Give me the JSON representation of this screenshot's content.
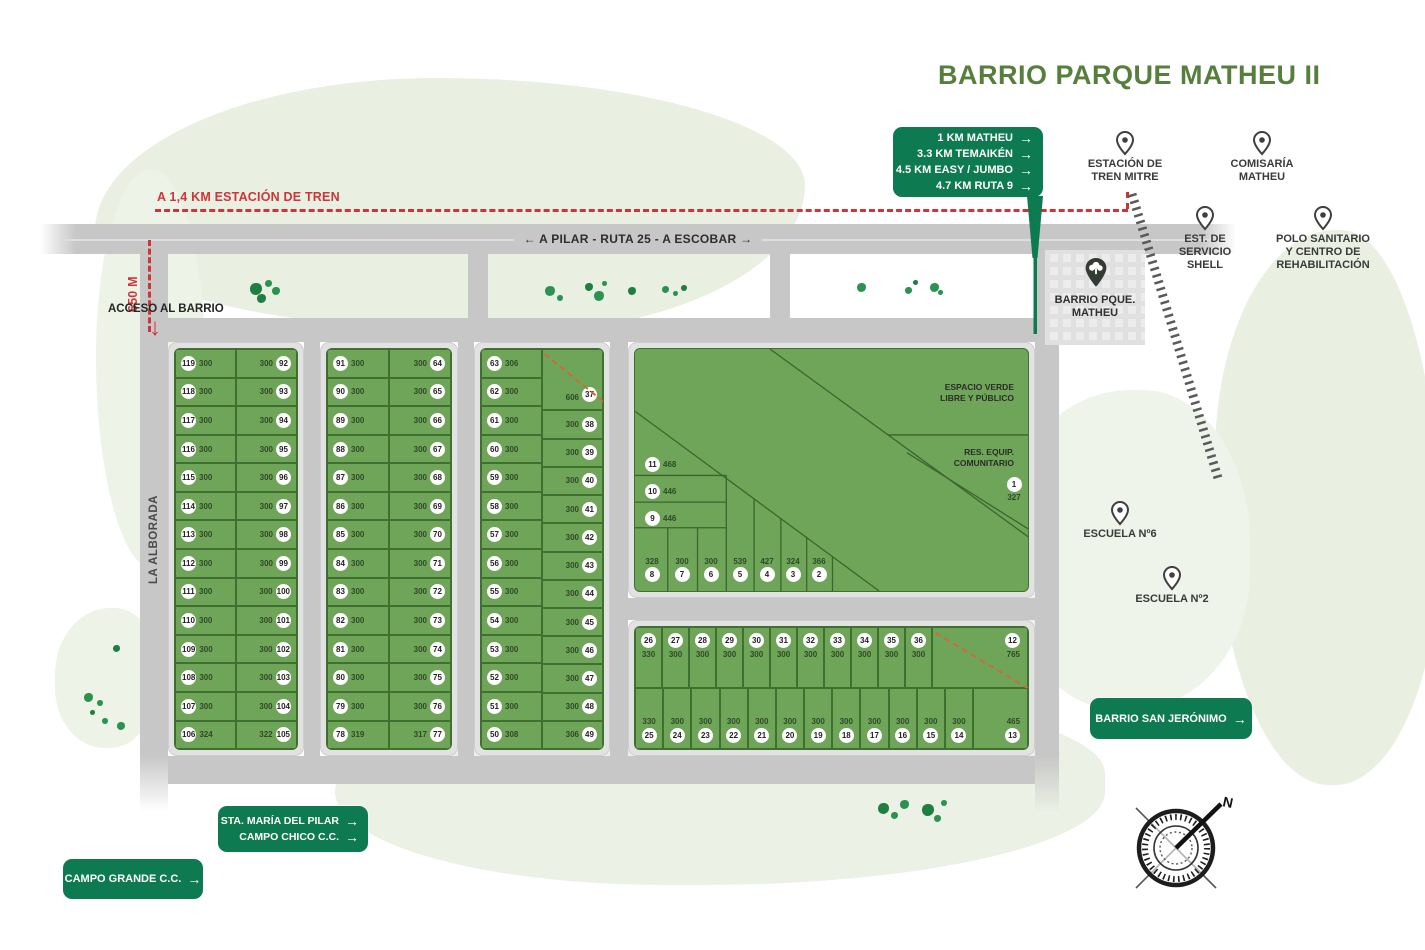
{
  "title": "BARRIO PARQUE MATHEU II",
  "arrow": "→",
  "colors": {
    "badge_green": "#0d7a52",
    "title_green": "#567f3d",
    "lot_green": "#6fa558",
    "lot_border": "#40702f",
    "road_gray": "#c7c7c7",
    "guide_red": "#ce3539"
  },
  "distance_badge": {
    "items": [
      "1 KM MATHEU",
      "3.3 KM TEMAIKÉN",
      "4.5 KM EASY / JUMBO",
      "4.7 KM RUTA 9"
    ]
  },
  "train_line_label": "A 1,4 KM ESTACIÓN DE TREN",
  "main_road_label": "← A PILAR - RUTA 25 - A ESCOBAR →",
  "access": {
    "label": "ACCESO AL BARRIO",
    "distance": "650 M"
  },
  "street_name": "LA ALBORADA",
  "compass": {
    "north_label": "N"
  },
  "pois": [
    {
      "id": "estacion-tren-mitre",
      "lines": [
        "ESTACIÓN DE",
        "TREN MITRE"
      ]
    },
    {
      "id": "comisaria-matheu",
      "lines": [
        "COMISARÍA",
        "MATHEU"
      ]
    },
    {
      "id": "est-servicio-shell",
      "lines": [
        "EST. DE",
        "SERVICIO",
        "SHELL"
      ]
    },
    {
      "id": "polo-sanitario",
      "lines": [
        "POLO SANITARIO",
        "Y CENTRO DE",
        "REHABILITACIÓN"
      ]
    },
    {
      "id": "escuela-6",
      "lines": [
        "ESCUELA Nº6"
      ]
    },
    {
      "id": "escuela-2",
      "lines": [
        "ESCUELA Nº2"
      ]
    }
  ],
  "barrio_marker": {
    "lines": [
      "BARRIO PQUE.",
      "MATHEU"
    ]
  },
  "nav_badges": {
    "san_jeronimo": {
      "label": "BARRIO SAN JERÓNIMO"
    },
    "sta_maria": {
      "lines": [
        "STA. MARÍA DEL PILAR",
        "CAMPO CHICO C.C."
      ]
    },
    "campo_grande": {
      "label": "CAMPO GRANDE C.C."
    }
  },
  "blocks": {
    "block1": {
      "left": [
        {
          "num": "119",
          "area": "300"
        },
        {
          "num": "118",
          "area": "300"
        },
        {
          "num": "117",
          "area": "300"
        },
        {
          "num": "116",
          "area": "300"
        },
        {
          "num": "115",
          "area": "300"
        },
        {
          "num": "114",
          "area": "300"
        },
        {
          "num": "113",
          "area": "300"
        },
        {
          "num": "112",
          "area": "300"
        },
        {
          "num": "111",
          "area": "300"
        },
        {
          "num": "110",
          "area": "300"
        },
        {
          "num": "109",
          "area": "300"
        },
        {
          "num": "108",
          "area": "300"
        },
        {
          "num": "107",
          "area": "300"
        },
        {
          "num": "106",
          "area": "324"
        }
      ],
      "right": [
        {
          "num": "92",
          "area": "300"
        },
        {
          "num": "93",
          "area": "300"
        },
        {
          "num": "94",
          "area": "300"
        },
        {
          "num": "95",
          "area": "300"
        },
        {
          "num": "96",
          "area": "300"
        },
        {
          "num": "97",
          "area": "300"
        },
        {
          "num": "98",
          "area": "300"
        },
        {
          "num": "99",
          "area": "300"
        },
        {
          "num": "100",
          "area": "300"
        },
        {
          "num": "101",
          "area": "300"
        },
        {
          "num": "102",
          "area": "300"
        },
        {
          "num": "103",
          "area": "300"
        },
        {
          "num": "104",
          "area": "300"
        },
        {
          "num": "105",
          "area": "322"
        }
      ]
    },
    "block2": {
      "left": [
        {
          "num": "91",
          "area": "300"
        },
        {
          "num": "90",
          "area": "300"
        },
        {
          "num": "89",
          "area": "300"
        },
        {
          "num": "88",
          "area": "300"
        },
        {
          "num": "87",
          "area": "300"
        },
        {
          "num": "86",
          "area": "300"
        },
        {
          "num": "85",
          "area": "300"
        },
        {
          "num": "84",
          "area": "300"
        },
        {
          "num": "83",
          "area": "300"
        },
        {
          "num": "82",
          "area": "300"
        },
        {
          "num": "81",
          "area": "300"
        },
        {
          "num": "80",
          "area": "300"
        },
        {
          "num": "79",
          "area": "300"
        },
        {
          "num": "78",
          "area": "319"
        }
      ],
      "right": [
        {
          "num": "64",
          "area": "300"
        },
        {
          "num": "65",
          "area": "300"
        },
        {
          "num": "66",
          "area": "300"
        },
        {
          "num": "67",
          "area": "300"
        },
        {
          "num": "68",
          "area": "300"
        },
        {
          "num": "69",
          "area": "300"
        },
        {
          "num": "70",
          "area": "300"
        },
        {
          "num": "71",
          "area": "300"
        },
        {
          "num": "72",
          "area": "300"
        },
        {
          "num": "73",
          "area": "300"
        },
        {
          "num": "74",
          "area": "300"
        },
        {
          "num": "75",
          "area": "300"
        },
        {
          "num": "76",
          "area": "300"
        },
        {
          "num": "77",
          "area": "317"
        }
      ]
    },
    "block3": {
      "left": [
        {
          "num": "63",
          "area": "306"
        },
        {
          "num": "62",
          "area": "300"
        },
        {
          "num": "61",
          "area": "300"
        },
        {
          "num": "60",
          "area": "300"
        },
        {
          "num": "59",
          "area": "300"
        },
        {
          "num": "58",
          "area": "300"
        },
        {
          "num": "57",
          "area": "300"
        },
        {
          "num": "56",
          "area": "300"
        },
        {
          "num": "55",
          "area": "300"
        },
        {
          "num": "54",
          "area": "300"
        },
        {
          "num": "53",
          "area": "300"
        },
        {
          "num": "52",
          "area": "300"
        },
        {
          "num": "51",
          "area": "300"
        },
        {
          "num": "50",
          "area": "308"
        }
      ],
      "right": [
        {
          "num": "37",
          "area": "606",
          "span": 2,
          "dashed": true
        },
        {
          "num": "38",
          "area": "300"
        },
        {
          "num": "39",
          "area": "300"
        },
        {
          "num": "40",
          "area": "300"
        },
        {
          "num": "41",
          "area": "300"
        },
        {
          "num": "42",
          "area": "300"
        },
        {
          "num": "43",
          "area": "300"
        },
        {
          "num": "44",
          "area": "300"
        },
        {
          "num": "45",
          "area": "300"
        },
        {
          "num": "46",
          "area": "300"
        },
        {
          "num": "47",
          "area": "300"
        },
        {
          "num": "48",
          "area": "300"
        },
        {
          "num": "49",
          "area": "306"
        }
      ]
    },
    "big": {
      "labels": {
        "espacio_verde": [
          "ESPACIO VERDE",
          "LIBRE Y PÚBLICO"
        ],
        "res_equip": [
          "RES. EQUIP.",
          "COMUNITARIO"
        ]
      },
      "strip_lots": [
        {
          "num": "11",
          "area": "468"
        },
        {
          "num": "10",
          "area": "446"
        },
        {
          "num": "9",
          "area": "446"
        }
      ],
      "bottom_lots": [
        {
          "num": "8",
          "area": "328"
        },
        {
          "num": "7",
          "area": "300"
        },
        {
          "num": "6",
          "area": "300"
        },
        {
          "num": "5",
          "area": "539"
        },
        {
          "num": "4",
          "area": "427"
        },
        {
          "num": "3",
          "area": "324"
        },
        {
          "num": "2",
          "area": "366"
        }
      ],
      "corner_lot": {
        "num": "1",
        "area": "327"
      }
    },
    "strip": {
      "top_row": [
        {
          "num": "26",
          "area": "330"
        },
        {
          "num": "27",
          "area": "300"
        },
        {
          "num": "28",
          "area": "300"
        },
        {
          "num": "29",
          "area": "300"
        },
        {
          "num": "30",
          "area": "300"
        },
        {
          "num": "31",
          "area": "300"
        },
        {
          "num": "32",
          "area": "300"
        },
        {
          "num": "33",
          "area": "300"
        },
        {
          "num": "34",
          "area": "300"
        },
        {
          "num": "35",
          "area": "300"
        },
        {
          "num": "36",
          "area": "300"
        },
        {
          "num": "12",
          "area": "765",
          "dashed": true,
          "wide": 96
        }
      ],
      "bottom_row": [
        {
          "num": "25",
          "area": "330"
        },
        {
          "num": "24",
          "area": "300"
        },
        {
          "num": "23",
          "area": "300"
        },
        {
          "num": "22",
          "area": "300"
        },
        {
          "num": "21",
          "area": "300"
        },
        {
          "num": "20",
          "area": "300"
        },
        {
          "num": "19",
          "area": "300"
        },
        {
          "num": "18",
          "area": "300"
        },
        {
          "num": "17",
          "area": "300"
        },
        {
          "num": "16",
          "area": "300"
        },
        {
          "num": "15",
          "area": "300"
        },
        {
          "num": "14",
          "area": "300"
        },
        {
          "num": "13",
          "area": "465",
          "wide": 55
        }
      ]
    }
  }
}
